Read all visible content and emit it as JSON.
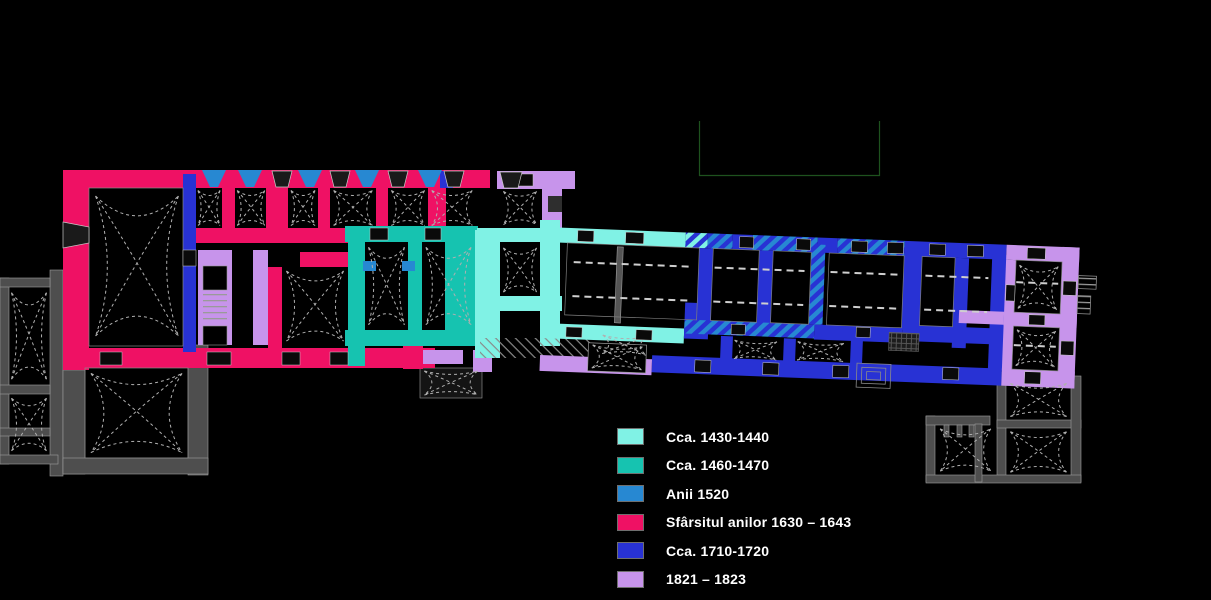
{
  "legend": {
    "items": [
      {
        "label": "Cca. 1430-1440",
        "color": "#80F2E5"
      },
      {
        "label": "Cca. 1460-1470",
        "color": "#16C3B0"
      },
      {
        "label": "Anii 1520",
        "color": "#2788D2"
      },
      {
        "label": "Sfârsitul anilor 1630 – 1643",
        "color": "#EF1164"
      },
      {
        "label": "Cca. 1710-1720",
        "color": "#2832D4"
      },
      {
        "label": "1821 – 1823",
        "color": "#C794EB"
      }
    ]
  },
  "colors": {
    "background": "#000000",
    "phase_1430": "#80F2E5",
    "phase_1460": "#16C3B0",
    "phase_1520": "#2788D2",
    "phase_1630": "#EF1164",
    "phase_1710": "#2832D4",
    "phase_1821": "#C794EB",
    "undated_gray": "#4E4E4E",
    "outline_gray": "#A8A8A8",
    "survey_green": "#1E521E"
  }
}
